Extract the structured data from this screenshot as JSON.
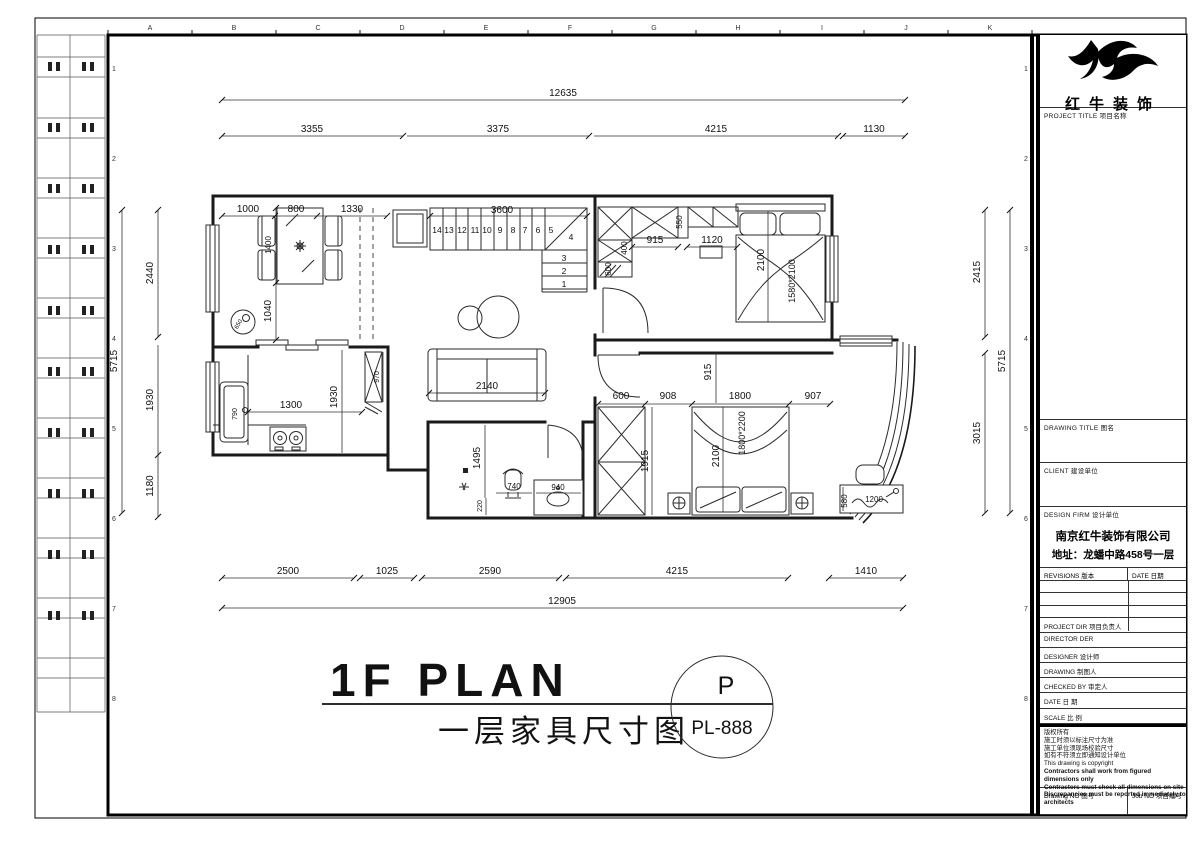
{
  "colors": {
    "line": "#1a1a1a",
    "background": "#ffffff"
  },
  "footer": {
    "title_en": "1F PLAN",
    "title_cn": "一层家具尺寸图",
    "tag_letter": "P",
    "tag_code": "PL-888"
  },
  "title_block": {
    "brand": "红牛装饰",
    "project_title_label": "PROJECT TITLE  项目名称",
    "drawing_title_label": "DRAWING TITLE  图名",
    "client_label": "CLIENT  建设单位",
    "design_firm_label": "DESIGN FIRM  设计单位",
    "firm_name": "南京红牛装饰有限公司",
    "firm_address": "地址：龙蟠中路458号一层",
    "revisions_label": "REVISIONS  版本",
    "date_col_label": "DATE  日期",
    "rows": [
      "PROJECT DIR  项目负责人",
      "DIRECTOR DER",
      "DESIGNER  设计师",
      "DRAWING  制图人",
      "CHECKED BY  审定人",
      "DATE  日 期",
      "SCALE  比 例"
    ],
    "notes": [
      "版权所有",
      "施工时须以标注尺寸为准",
      "施工单位须现场校验尺寸",
      "如有不符须立即通知设计单位",
      "This drawing is copyright",
      "Contractors shall work from figured dimensions only",
      "Contractors must check all dimensions on site",
      "Discrepancies must be reported immediately to architects"
    ],
    "drawing_no_label": "Drawing NO  图号",
    "job_no_label": "Job NO  项目编号"
  },
  "plan": {
    "grid": {
      "top": [
        "A",
        "B",
        "C",
        "D",
        "E",
        "F",
        "G",
        "H",
        "I",
        "J",
        "K"
      ],
      "side": [
        "1",
        "2",
        "3",
        "4",
        "5",
        "6",
        "7",
        "8"
      ]
    },
    "stairs": [
      "14",
      "13",
      "12",
      "11",
      "10",
      "9",
      "8",
      "7",
      "6",
      "5",
      "4",
      "3",
      "2",
      "1"
    ],
    "dims": {
      "top_overall": "12635",
      "top_1": "3355",
      "top_2": "3375",
      "top_3": "4215",
      "top_4": "1130",
      "bot_1": "2500",
      "bot_2": "1025",
      "bot_3": "2590",
      "bot_4": "4215",
      "bot_5": "1410",
      "bot_overall": "12905",
      "left_overall": "5715",
      "left_1": "2440",
      "left_2": "1930",
      "left_3": "1180",
      "right_1": "2415",
      "right_2": "3015",
      "right_overall": "5715",
      "din_1": "1000",
      "din_2": "800",
      "din_3": "1330",
      "din_v1": "1400",
      "din_v2": "1040",
      "din_circle": "650",
      "stair_run": "3600",
      "wr_550": "550",
      "wr_400": "400",
      "wr_600": "600",
      "wr_915": "915",
      "wr_1120": "1120",
      "bed1_2100": "2100",
      "bed1_label": "1580*2100",
      "sofa_2140": "2140",
      "kit_1300": "1300",
      "kit_1930": "1930",
      "kit_970": "970",
      "kit_sink": "790",
      "bath_1495": "1495",
      "bath_740": "740",
      "bath_940": "940",
      "bath_220": "220",
      "cor_915": "915",
      "br2_600": "600",
      "br2_908": "908",
      "br2_1800": "1800",
      "br2_907": "907",
      "br2_1915": "1915",
      "bed2_2100": "2100",
      "bed2_label": "1800*2200",
      "desk_1200": "1200",
      "desk_580": "580"
    }
  }
}
